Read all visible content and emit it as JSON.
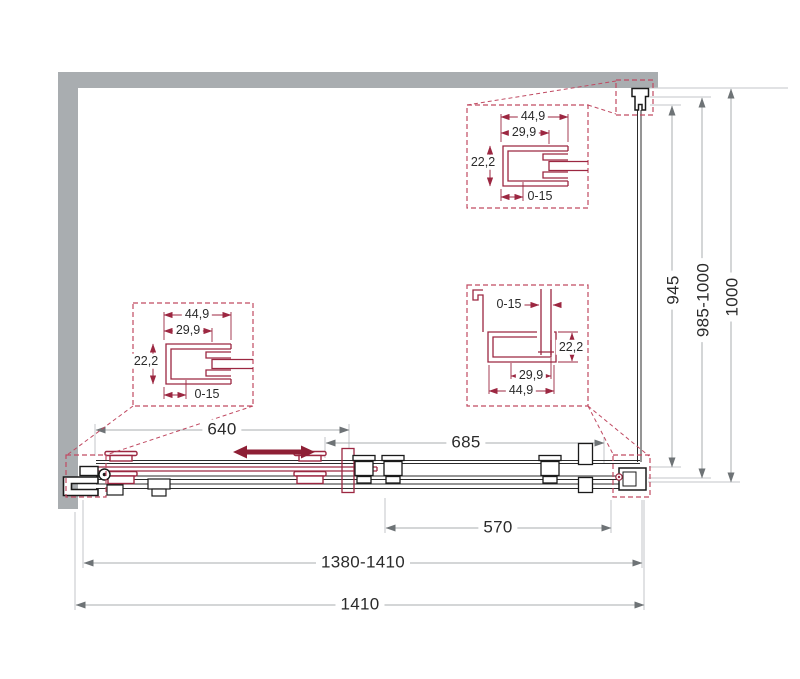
{
  "dims": {
    "door_slide": "640",
    "fixed_section": "685",
    "fixed_glass": "570",
    "width_range": "1380-1410",
    "width_total": "1410",
    "glass_height": "945",
    "height_range": "985-1000",
    "height_total": "1000"
  },
  "callout_top": {
    "width_outer": "44,9",
    "width_inner": "29,9",
    "height": "22,2",
    "adjustment": "0-15"
  },
  "callout_left": {
    "width_outer": "44,9",
    "width_inner": "29,9",
    "height": "22,2",
    "adjustment": "0-15"
  },
  "callout_right": {
    "adjustment": "0-15",
    "height": "22,2",
    "width_inner": "29,9",
    "width_outer": "44,9"
  },
  "colors": {
    "wall": "#a9adb0",
    "outline": "#1a1a1a",
    "maroon": "#9c2741",
    "accent_dashed": "#c04a62",
    "dim_line": "#a8acaf",
    "dim_text": "#2b2b2b",
    "arrow": "#8e1f35"
  }
}
